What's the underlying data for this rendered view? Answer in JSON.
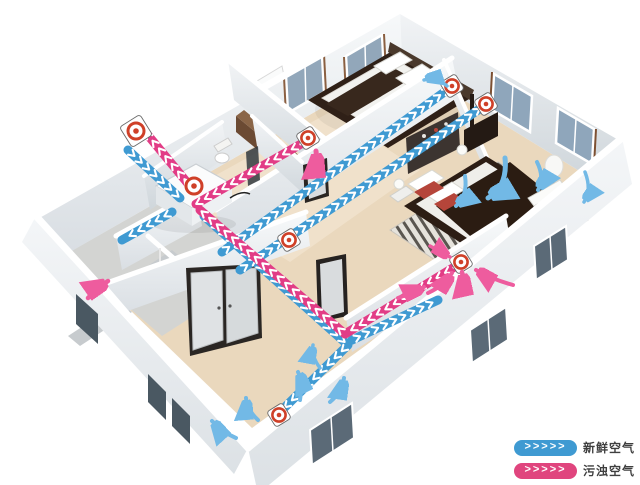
{
  "diagram_title": "home-fresh-air-ventilation-system",
  "legend": {
    "chevrons": ">>>>>",
    "items": [
      {
        "id": "fresh",
        "label": "新鲜空气",
        "color": "#3f9ad2"
      },
      {
        "id": "exhaust",
        "label": "污浊空气",
        "color": "#e0457e"
      }
    ]
  },
  "colors": {
    "fresh": "#3f9ad2",
    "exhaust": "#e23c86",
    "fresh_arrow": "#72b9e6",
    "exhaust_arrow": "#ee5c9e",
    "chevron": "#ffffff",
    "vent_ring": "#cf4028",
    "floor": "#ead8bd",
    "wall": "#eef1f3",
    "label_text": "#3f3f3f"
  },
  "ducts": [
    {
      "id": "fresh-intake",
      "color_key": "fresh",
      "points": [
        [
          128,
          150
        ],
        [
          180,
          198
        ]
      ]
    },
    {
      "id": "fresh-trunk-living",
      "color_key": "fresh",
      "points": [
        [
          204,
          216
        ],
        [
          348,
          345
        ],
        [
          279,
          413
        ]
      ]
    },
    {
      "id": "fresh-branch-master-low",
      "color_key": "fresh",
      "points": [
        [
          352,
          340
        ],
        [
          438,
          300
        ]
      ]
    },
    {
      "id": "fresh-corridor-upper",
      "color_key": "fresh",
      "points": [
        [
          222,
          252
        ],
        [
          450,
          88
        ]
      ]
    },
    {
      "id": "fresh-corridor-lower",
      "color_key": "fresh",
      "points": [
        [
          240,
          270
        ],
        [
          484,
          106
        ]
      ]
    },
    {
      "id": "fresh-stub-downstairs",
      "color_key": "fresh",
      "points": [
        [
          172,
          212
        ],
        [
          122,
          240
        ]
      ]
    },
    {
      "id": "exhaust-to-outside",
      "color_key": "exhaust",
      "points": [
        [
          190,
          186
        ],
        [
          142,
          128
        ]
      ]
    },
    {
      "id": "exhaust-bedroom1",
      "color_key": "exhaust",
      "points": [
        [
          308,
          140
        ],
        [
          196,
          204
        ]
      ]
    },
    {
      "id": "exhaust-master-trunk",
      "color_key": "exhaust",
      "points": [
        [
          461,
          263
        ],
        [
          345,
          334
        ],
        [
          200,
          210
        ]
      ]
    }
  ],
  "vents": [
    {
      "id": "exterior-wall-vent",
      "x": 136,
      "y": 131,
      "kind": "exterior-vent",
      "size": "lg"
    },
    {
      "id": "hrv-top-port",
      "x": 194,
      "y": 186,
      "kind": "unit-port",
      "size": "lg"
    },
    {
      "id": "supply-diffuser-1",
      "x": 452,
      "y": 86,
      "kind": "supply-diffuser",
      "size": "md"
    },
    {
      "id": "supply-diffuser-2",
      "x": 486,
      "y": 104,
      "kind": "supply-diffuser",
      "size": "md"
    },
    {
      "id": "living-floor-diffuser",
      "x": 279,
      "y": 415,
      "kind": "supply-diffuser",
      "size": "md"
    },
    {
      "id": "extract-bedroom1",
      "x": 308,
      "y": 138,
      "kind": "extract-vent",
      "size": "md"
    },
    {
      "id": "extract-hall",
      "x": 289,
      "y": 240,
      "kind": "extract-vent",
      "size": "md"
    },
    {
      "id": "extract-master",
      "x": 461,
      "y": 262,
      "kind": "extract-vent",
      "size": "md"
    }
  ],
  "flow_arrows": [
    {
      "id": "bedroom1-supply",
      "color_key": "fresh_arrow",
      "w": 3.5,
      "d": "M 447,86 Q 436,76 424,80"
    },
    {
      "id": "master-supply-1",
      "color_key": "fresh_arrow",
      "w": 5,
      "d": "M 505,158 Q 508,186 488,198"
    },
    {
      "id": "master-supply-2",
      "color_key": "fresh_arrow",
      "w": 4,
      "d": "M 465,176 Q 468,196 456,206"
    },
    {
      "id": "master-supply-3",
      "color_key": "fresh_arrow",
      "w": 4,
      "d": "M 537,162 Q 545,178 538,190"
    },
    {
      "id": "master-supply-4",
      "color_key": "fresh_arrow",
      "w": 3.5,
      "d": "M 585,172 Q 592,190 584,202"
    },
    {
      "id": "living-circ-1",
      "color_key": "fresh_arrow",
      "w": 4,
      "d": "M 300,400 Q 303,382 298,372"
    },
    {
      "id": "living-circ-2",
      "color_key": "fresh_arrow",
      "w": 4,
      "d": "M 330,402 Q 342,392 344,378"
    },
    {
      "id": "living-circ-3",
      "color_key": "fresh_arrow",
      "w": 4,
      "d": "M 258,420 Q 247,410 246,398"
    },
    {
      "id": "living-circ-4",
      "color_key": "fresh_arrow",
      "w": 4,
      "d": "M 236,438 Q 222,432 212,421"
    },
    {
      "id": "living-circ-5",
      "color_key": "fresh_arrow",
      "w": 3.5,
      "d": "M 320,368 Q 311,356 313,345"
    },
    {
      "id": "stairs-up",
      "color_key": "exhaust_arrow",
      "w": 4.5,
      "d": "M 88,298 Q 98,288 108,281"
    },
    {
      "id": "bedroom1-extract",
      "color_key": "exhaust_arrow",
      "w": 5,
      "d": "M 319,174 Q 317,162 316,151"
    },
    {
      "id": "master-extract-1",
      "color_key": "exhaust_arrow",
      "w": 4,
      "d": "M 428,293 Q 445,285 452,273"
    },
    {
      "id": "master-extract-2",
      "color_key": "exhaust_arrow",
      "w": 4,
      "d": "M 513,285 Q 494,280 476,270"
    },
    {
      "id": "master-extract-3",
      "color_key": "exhaust_arrow",
      "w": 4.5,
      "d": "M 466,291 Q 464,281 462,272"
    },
    {
      "id": "master-extract-4",
      "color_key": "exhaust_arrow",
      "w": 3.5,
      "d": "M 430,246 Q 441,252 450,257"
    },
    {
      "id": "master-extract-5",
      "color_key": "exhaust_arrow",
      "w": 4,
      "d": "M 398,298 Q 412,293 424,287"
    }
  ]
}
